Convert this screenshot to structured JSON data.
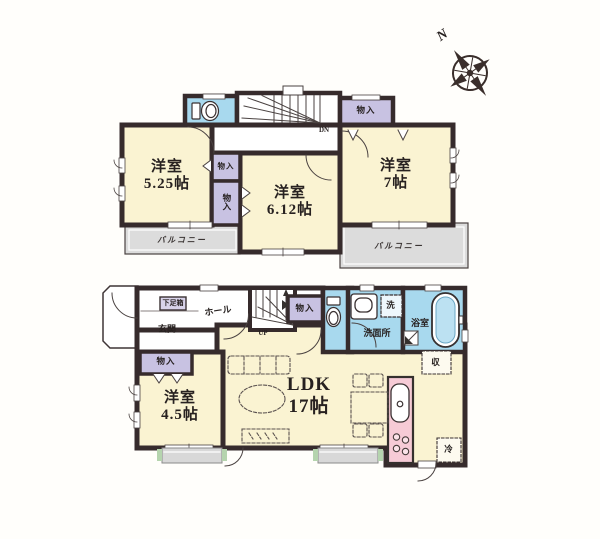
{
  "colors": {
    "wall": "#362b2c",
    "room_cream": "#faf3d2",
    "closet_lavender": "#c8c2e2",
    "water_blue": "#a8d9ee",
    "balcony_gray": "#dcdcdc",
    "kitchen_pink": "#f6cbd6",
    "step_green": "#b5d4ae"
  },
  "icons": {
    "toilet_2f": "toilet-top-view",
    "toilet_1f": "toilet-top-view",
    "bathtub": "bathtub-top-view",
    "vanity": "sink-top-view",
    "kitchen_sink": "kitchen-sink",
    "stove": "stove-burners",
    "compass": "compass-rose"
  },
  "compass": {
    "north_label": "N"
  },
  "floor2": {
    "bedroom_525": {
      "name": "洋室",
      "size": "5.25帖"
    },
    "bedroom_612": {
      "name": "洋室",
      "size": "6.12帖"
    },
    "bedroom_7": {
      "name": "洋室",
      "size": "7帖"
    },
    "closet_top": {
      "label": "物入"
    },
    "closet_upper": {
      "label": "物入"
    },
    "closet_lower": {
      "label": "物入"
    },
    "balcony_left": {
      "label": "バルコニー"
    },
    "balcony_right": {
      "label": "バルコニー"
    },
    "stairs": {
      "label": "DN"
    }
  },
  "floor1": {
    "shoe_box": {
      "label": "下足箱"
    },
    "entrance": {
      "label": "玄関"
    },
    "hall": {
      "label": "ホール"
    },
    "stairs": {
      "label": "UP"
    },
    "closet_hall": {
      "label": "物入"
    },
    "washer": {
      "label": "洗"
    },
    "washroom": {
      "label": "洗面所"
    },
    "bathroom": {
      "label": "浴室"
    },
    "ldk": {
      "name": "LDK",
      "size": "17帖"
    },
    "bedroom_45": {
      "name": "洋室",
      "size": "4.5帖"
    },
    "closet_bedroom": {
      "label": "物入"
    },
    "storage": {
      "label": "収"
    },
    "refrigerator": {
      "label": "冷"
    }
  }
}
